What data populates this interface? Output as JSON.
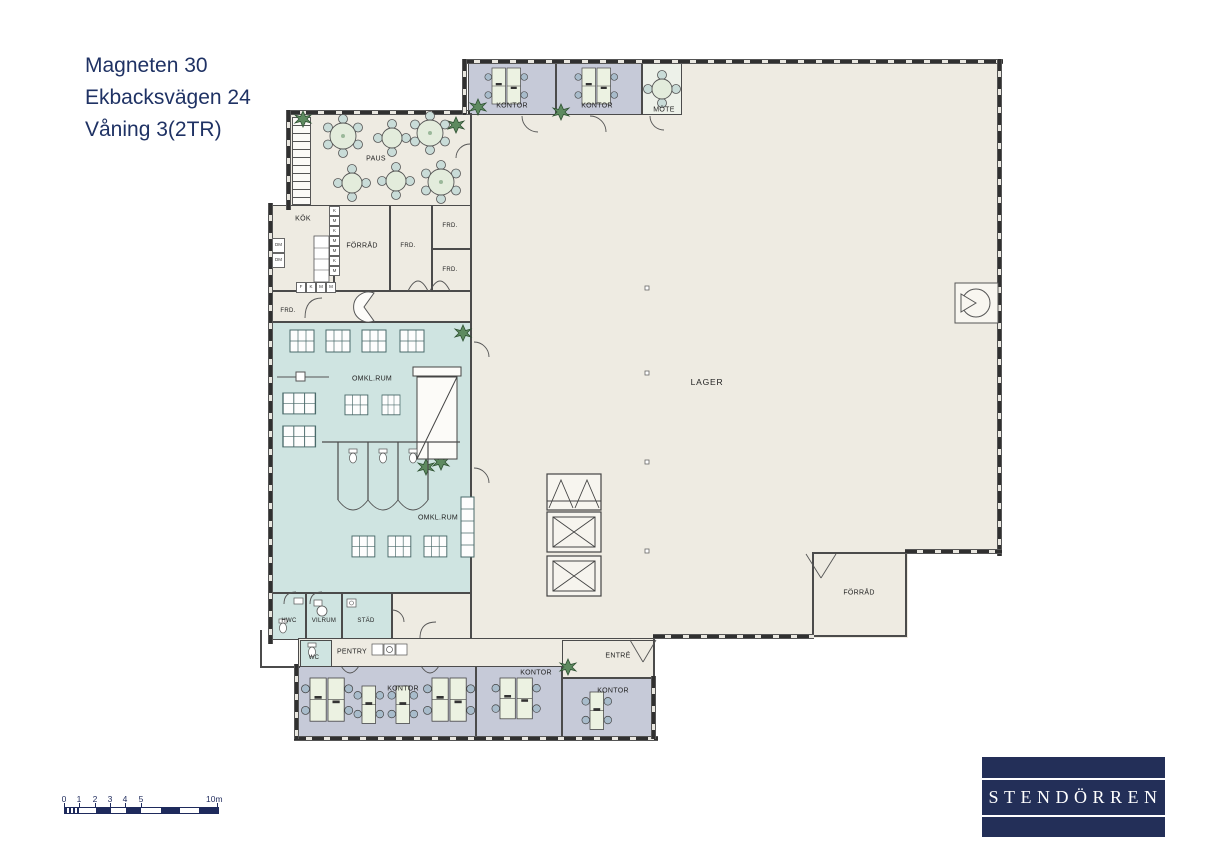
{
  "title": {
    "line1": "Magneten 30",
    "line2": "Ekbacksvägen 24",
    "line3": "Våning 3(2TR)"
  },
  "rooms": {
    "kontor_top_left": "KONTOR",
    "kontor_top_right": "KONTOR",
    "mote": "MÖTE",
    "paus": "PAUS",
    "kok": "KÖK",
    "forrad_upper": "FÖRRÅD",
    "frd_mid": "FRD.",
    "frd_top_right": "FRD.",
    "frd_bottom_right": "FRD.",
    "frd_left": "FRD.",
    "omkl_upper": "OMKL.RUM",
    "omkl_lower": "OMKL.RUM",
    "lager": "LAGER",
    "forrad_lower": "FÖRRÅD",
    "hwc": "HWC",
    "vilrum": "VILRUM",
    "stad": "STÄD",
    "wc": "WC",
    "pentry": "PENTRY",
    "entre": "ENTRÉ",
    "kontor_bottom_left": "KONTOR",
    "kontor_bottom_mid": "KONTOR",
    "kontor_bottom_right": "KONTOR"
  },
  "kitchen": {
    "column_units": [
      "K",
      "M",
      "K",
      "M",
      "M",
      "K",
      "M"
    ],
    "row_units": [
      "F",
      "K",
      "M",
      "M"
    ],
    "left_units": [
      "DM",
      "DM"
    ]
  },
  "scale_bar": {
    "ticks": [
      "0",
      "1",
      "2",
      "3",
      "4",
      "5"
    ],
    "end_label": "10m"
  },
  "logo": {
    "text": "STENDÖRREN"
  },
  "colors": {
    "navy": "#232f58",
    "title_navy": "#1f3264",
    "beige": "#eeebe2",
    "teal": "#cfe4e1",
    "office_gray": "#c6cad8",
    "wall": "#4b4b4b",
    "plant_green": "#5d8a5f",
    "table_green": "#e3ecdc"
  }
}
